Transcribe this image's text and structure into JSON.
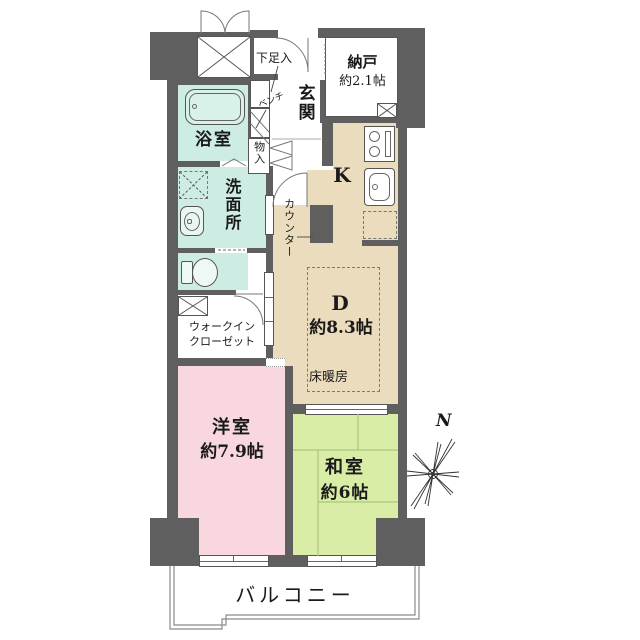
{
  "plan": {
    "rooms": {
      "bathroom": {
        "label": "浴室"
      },
      "washroom": {
        "label": "洗面所"
      },
      "entrance": {
        "label": "玄関"
      },
      "shoe_cabinet": {
        "label": "下足入"
      },
      "bench": {
        "label": "ベンチ"
      },
      "storage": {
        "label": "物入"
      },
      "nando": {
        "label": "納戸",
        "size": "約2.1帖"
      },
      "kitchen": {
        "label": "K"
      },
      "counter": {
        "label": "カウンター"
      },
      "dining": {
        "label": "D",
        "size": "約8.3帖"
      },
      "floor_heating": {
        "label": "床暖房"
      },
      "wic": {
        "label_line1": "ウォークイン",
        "label_line2": "クローゼット"
      },
      "western_room": {
        "label": "洋室",
        "size": "約7.9帖"
      },
      "japanese_room": {
        "label": "和室",
        "size": "約6帖"
      },
      "balcony": {
        "label": "バルコニー"
      }
    },
    "compass": {
      "label": "N"
    },
    "colors": {
      "wall": "#5f5f5f",
      "dk_floor": "#ebdcbe",
      "western_floor": "#f8d8de",
      "japanese_floor": "#d9eda6",
      "wet_floor": "#cdece4"
    }
  }
}
